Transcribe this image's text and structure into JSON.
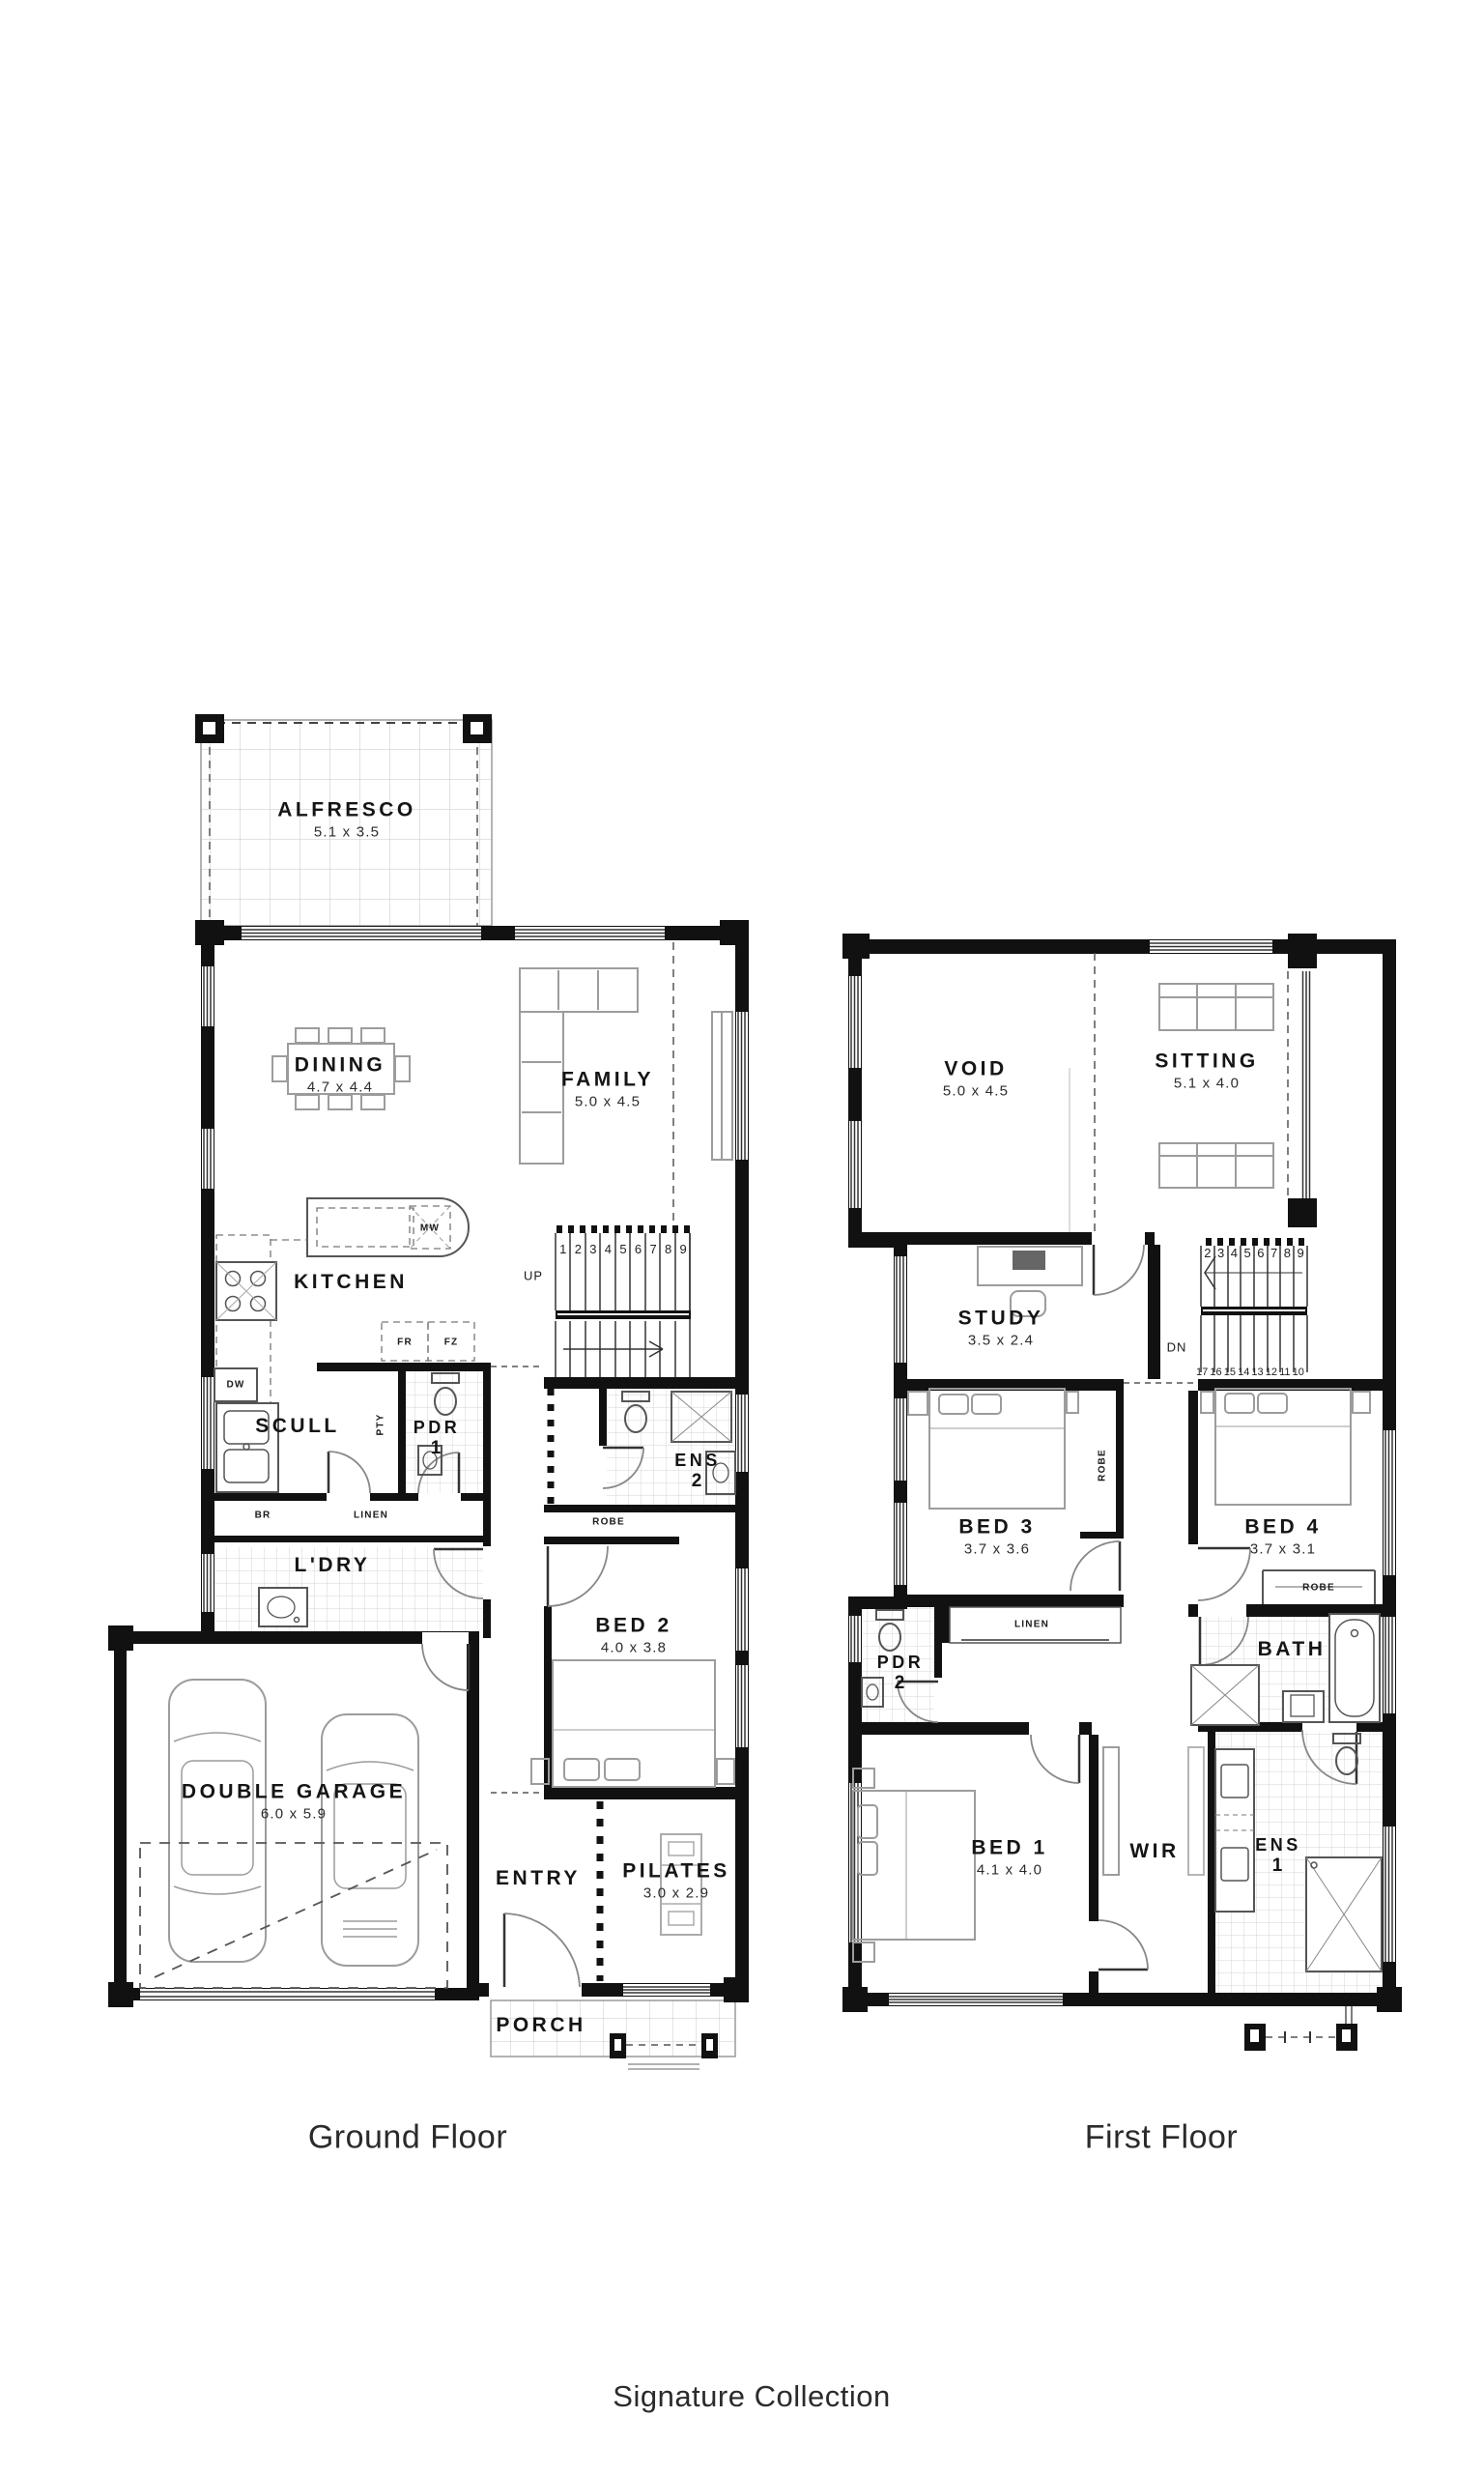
{
  "ground": {
    "caption": "Ground Floor",
    "rooms": {
      "alfresco": {
        "name": "ALFRESCO",
        "dims": "5.1 x 3.5"
      },
      "dining": {
        "name": "DINING",
        "dims": "4.7 x 4.4"
      },
      "family": {
        "name": "FAMILY",
        "dims": "5.0 x 4.5"
      },
      "kitchen": {
        "name": "KITCHEN"
      },
      "scull": {
        "name": "SCULL"
      },
      "pdr1": {
        "name": "PDR",
        "number": "1"
      },
      "ens2": {
        "name": "ENS",
        "number": "2"
      },
      "ldry": {
        "name": "L'DRY"
      },
      "bed2": {
        "name": "BED 2",
        "dims": "4.0 x 3.8"
      },
      "garage": {
        "name": "DOUBLE GARAGE",
        "dims": "6.0 x 5.9"
      },
      "entry": {
        "name": "ENTRY"
      },
      "pilates": {
        "name": "PILATES",
        "dims": "3.0 x 2.9"
      },
      "porch": {
        "name": "PORCH"
      }
    },
    "fixtures": {
      "mw": "MW",
      "fr": "FR",
      "fz": "FZ",
      "dw": "DW",
      "pty": "PTY",
      "br": "BR",
      "linen": "LINEN",
      "robe": "ROBE",
      "up": "UP"
    },
    "stairs": [
      "1",
      "2",
      "3",
      "4",
      "5",
      "6",
      "7",
      "8",
      "9"
    ]
  },
  "first": {
    "caption": "First Floor",
    "rooms": {
      "void": {
        "name": "VOID",
        "dims": "5.0 x 4.5"
      },
      "sitting": {
        "name": "SITTING",
        "dims": "5.1 x 4.0"
      },
      "study": {
        "name": "STUDY",
        "dims": "3.5 x 2.4"
      },
      "bed3": {
        "name": "BED 3",
        "dims": "3.7 x 3.6"
      },
      "bed4": {
        "name": "BED 4",
        "dims": "3.7 x 3.1"
      },
      "pdr2": {
        "name": "PDR",
        "number": "2"
      },
      "bath": {
        "name": "BATH"
      },
      "bed1": {
        "name": "BED 1",
        "dims": "4.1 x 4.0"
      },
      "wir": {
        "name": "WIR"
      },
      "ens1": {
        "name": "ENS",
        "number": "1"
      }
    },
    "fixtures": {
      "robe_bed3": "ROBE",
      "robe_bed4": "ROBE",
      "linen": "LINEN",
      "dn": "DN"
    },
    "stairs_upper": [
      "2",
      "3",
      "4",
      "5",
      "6",
      "7",
      "8",
      "9"
    ],
    "stairs_lower": [
      "17",
      "16",
      "15",
      "14",
      "13",
      "12",
      "11",
      "10"
    ]
  },
  "footer": {
    "brand": "Signature Collection"
  }
}
